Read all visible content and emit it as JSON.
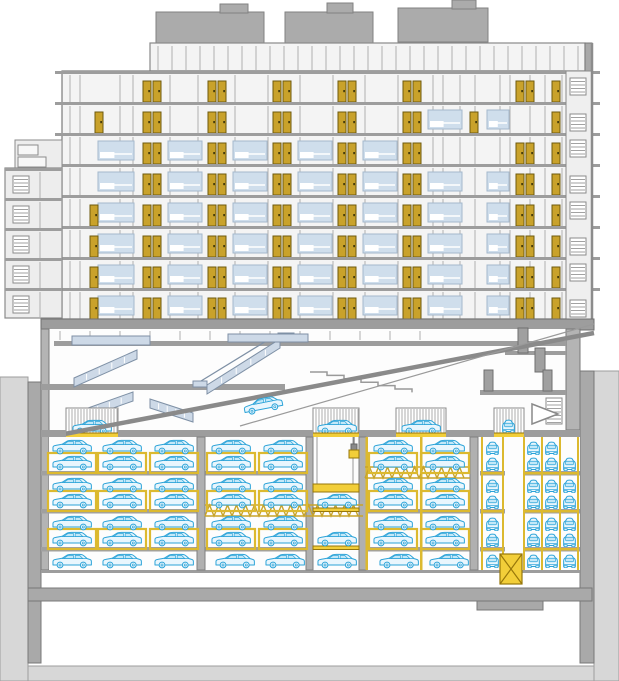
{
  "meta": {
    "title": "Architectural cross-section: residential tower over lobby and automated underground parking garage"
  },
  "palette": {
    "terrain": "#d7d7d7",
    "terrain_line": "#9e9e9e",
    "wall": "#a9a9a9",
    "wall_line": "#787878",
    "slab": "#9d9d9d",
    "floor_bg": "#f4f4f4",
    "room_bg": "#fdfdfd",
    "roof_unit": "#ababab",
    "roof_line": "#828282",
    "mullion": "#b0b0b0",
    "window_fill": "#cfdeec",
    "window_line": "#a4b8cc",
    "door_gold": "#c9a22b",
    "door_line": "#6e5a0e",
    "rack_yellow": "#dcb92f",
    "lift_yellow": "#f2ce39",
    "lift_line": "#97770a",
    "truss_yellow": "#c8a42a",
    "car_stroke": "#2ba3d8",
    "car_body": "#e9f6fd",
    "car_glass": "#c3e8f8",
    "stair_blue": "#cdd9e7",
    "stair_line": "#7e90a5"
  },
  "scene": {
    "terrain": {
      "left": [
        0,
        377,
        28,
        304
      ],
      "right": [
        594,
        371,
        25,
        310
      ],
      "bottom": [
        0,
        666,
        619,
        15
      ],
      "left_wall": [
        28,
        382,
        13,
        281
      ],
      "right_wall": [
        580,
        371,
        14,
        292
      ],
      "foundation": [
        28,
        588,
        564,
        13
      ],
      "pit": [
        477,
        588,
        66,
        22
      ]
    },
    "roof_units": [
      [
        156,
        12,
        108,
        31
      ],
      [
        220,
        4,
        28,
        9
      ],
      [
        285,
        12,
        88,
        31
      ],
      [
        327,
        3,
        26,
        10
      ],
      [
        398,
        8,
        90,
        34
      ],
      [
        452,
        0,
        24,
        9
      ]
    ],
    "top_band": {
      "x": 150,
      "y": 43,
      "w": 435,
      "h": 28,
      "mullion_step": 14
    },
    "tower": {
      "x": 62,
      "y": 71,
      "w": 523,
      "h": 248,
      "floor_h": 31,
      "slab": [
        55,
        545
      ],
      "mullions": [
        70,
        80,
        120,
        133,
        170,
        198,
        235,
        268,
        300,
        333,
        365,
        398,
        433,
        443,
        460,
        475,
        500,
        510,
        530,
        545,
        562,
        575
      ],
      "floors": [
        {
          "pairs": [
            143,
            208,
            273,
            338,
            403,
            516
          ],
          "singles": [
            552
          ],
          "windows": []
        },
        {
          "pairs": [
            143,
            208,
            273,
            338,
            403
          ],
          "singles": [
            95,
            470,
            552
          ],
          "windows": [
            [
              428,
              34
            ],
            [
              487,
              22
            ]
          ]
        },
        {
          "pairs": [
            143,
            208,
            273,
            338,
            403,
            516
          ],
          "singles": [
            552
          ],
          "windows": [
            [
              98,
              36
            ],
            [
              168,
              34
            ],
            [
              233,
              34
            ],
            [
              298,
              34
            ],
            [
              363,
              34
            ]
          ]
        },
        {
          "pairs": [
            143,
            208,
            273,
            338,
            403,
            516
          ],
          "singles": [
            552
          ],
          "windows": [
            [
              98,
              36
            ],
            [
              168,
              34
            ],
            [
              233,
              34
            ],
            [
              298,
              34
            ],
            [
              363,
              34
            ],
            [
              428,
              34
            ],
            [
              487,
              22
            ]
          ]
        },
        {
          "pairs": [
            143,
            208,
            273,
            338,
            403,
            516
          ],
          "singles": [
            90,
            552
          ],
          "windows": [
            [
              98,
              36
            ],
            [
              168,
              34
            ],
            [
              233,
              34
            ],
            [
              298,
              34
            ],
            [
              363,
              34
            ],
            [
              428,
              34
            ],
            [
              487,
              22
            ]
          ]
        },
        {
          "pairs": [
            143,
            208,
            273,
            338,
            403,
            516
          ],
          "singles": [
            90,
            552
          ],
          "windows": [
            [
              98,
              36
            ],
            [
              168,
              34
            ],
            [
              233,
              34
            ],
            [
              298,
              34
            ],
            [
              363,
              34
            ],
            [
              428,
              34
            ],
            [
              487,
              22
            ]
          ]
        },
        {
          "pairs": [
            143,
            208,
            273,
            338,
            403,
            516
          ],
          "singles": [
            90,
            552
          ],
          "windows": [
            [
              98,
              36
            ],
            [
              168,
              34
            ],
            [
              233,
              34
            ],
            [
              298,
              34
            ],
            [
              363,
              34
            ],
            [
              428,
              34
            ],
            [
              487,
              22
            ]
          ]
        },
        {
          "pairs": [
            143,
            208,
            273,
            338,
            403,
            516
          ],
          "singles": [
            90,
            552
          ],
          "windows": [
            [
              98,
              36
            ],
            [
              168,
              34
            ],
            [
              233,
              34
            ],
            [
              298,
              34
            ],
            [
              363,
              34
            ],
            [
              428,
              34
            ],
            [
              487,
              22
            ]
          ]
        }
      ]
    },
    "wing": {
      "a": [
        15,
        140,
        47,
        28
      ],
      "x": 5,
      "w": 57,
      "top": 168,
      "floor_h": 30,
      "count": 5
    },
    "shaft": {
      "x": 566,
      "y": 43,
      "w": 26,
      "bottom": 319,
      "hatch_x": 570,
      "floor_ys": [
        71,
        102,
        133,
        164,
        195,
        226,
        257,
        288
      ]
    },
    "podium": [
      41,
      319,
      553,
      11
    ],
    "lobby": {
      "bg": [
        49,
        329,
        531,
        108
      ],
      "left_wall": [
        41,
        329,
        8,
        241
      ],
      "right_wall": [
        566,
        329,
        14,
        101
      ],
      "ceiling": [
        54,
        341,
        512,
        5
      ],
      "mezz": [
        41,
        384,
        244,
        6
      ],
      "railing": {
        "x1": 60,
        "x2": 420,
        "y": 331,
        "h": 9,
        "step": 30
      },
      "landing": [
        72,
        336,
        78,
        9
      ],
      "flights": [
        [
          137,
          350,
          74,
          378
        ],
        [
          133,
          392,
          74,
          413
        ],
        [
          150,
          399,
          193,
          413
        ]
      ],
      "esc": {
        "x1": 207,
        "y1": 385,
        "x2": 280,
        "y2": 339
      },
      "esc_bar": [
        228,
        334,
        80,
        8
      ],
      "amphi": {
        "x": 310,
        "y": 372,
        "steps": 6,
        "dx": 17,
        "dy": 3.4
      },
      "ramp": [
        54,
        436,
        594,
        333
      ],
      "rail": [
        240,
        426,
        594,
        324
      ],
      "doors": [
        [
          518,
          328,
          10,
          25
        ],
        [
          535,
          348,
          10,
          24
        ],
        [
          484,
          370,
          9,
          21
        ],
        [
          543,
          370,
          9,
          21
        ]
      ],
      "slabs": [
        [
          505,
          351,
          61,
          4
        ],
        [
          480,
          390,
          86,
          5
        ]
      ],
      "stair_hatch": [
        546,
        398,
        16,
        26
      ],
      "arrow": [
        [
          532,
          404
        ],
        [
          558,
          414
        ],
        [
          532,
          424
        ]
      ],
      "lift_y": 408,
      "lift_h": 26,
      "car_y": 419,
      "lifts": [
        {
          "x": 66,
          "w": 52,
          "car": "side",
          "cx": 70
        },
        {
          "x": 313,
          "w": 46,
          "car": "side",
          "cx": 315
        },
        {
          "x": 396,
          "w": 50,
          "car": "side",
          "cx": 399
        },
        {
          "x": 494,
          "w": 30,
          "car": "front",
          "cx": 500
        }
      ],
      "ramp_car": {
        "x": 241,
        "y": 397,
        "rot": -11,
        "cx": 263,
        "cy": 405
      }
    },
    "parking": {
      "bg": [
        49,
        437,
        531,
        133
      ],
      "ceiling_y": 430,
      "ceiling_h": 7,
      "ceiling_spans": [
        [
          41,
          25
        ],
        [
          118,
          195
        ],
        [
          359,
          37
        ],
        [
          446,
          48
        ],
        [
          524,
          56
        ]
      ],
      "slabs": [
        {
          "y": 471,
          "spans": [
            [
              41,
              156
            ],
            [
              205,
              108
            ],
            [
              480,
              25
            ],
            [
              523,
              57
            ]
          ]
        },
        {
          "y": 509,
          "spans": [
            [
              41,
              156
            ],
            [
              365,
              105
            ],
            [
              480,
              25
            ],
            [
              523,
              57
            ]
          ]
        },
        {
          "y": 547,
          "spans": [
            [
              41,
              156
            ],
            [
              205,
              108
            ],
            [
              365,
              105
            ],
            [
              480,
              25
            ],
            [
              523,
              57
            ]
          ]
        }
      ],
      "floor": [
        41,
        570,
        539,
        3
      ],
      "columns": [
        [
          197,
          437,
          8,
          133
        ],
        [
          470,
          437,
          8,
          133
        ],
        [
          306,
          437,
          7,
          133
        ],
        [
          359,
          437,
          7,
          133
        ]
      ],
      "posts": [
        365.5,
        420
      ],
      "trusses": [
        [
          365,
          467,
          105,
          11
        ],
        [
          205,
          505,
          158,
          11
        ]
      ],
      "frames": {
        "ys": [
          453,
          491,
          529
        ],
        "cols": [
          50,
          100,
          152,
          209,
          261,
          371,
          423
        ]
      },
      "side_cars": [
        [
          439,
          [
            50,
            100,
            152,
            209,
            261,
            371,
            423
          ]
        ],
        [
          455,
          [
            50,
            100,
            152,
            209,
            261,
            371,
            423
          ]
        ],
        [
          477,
          [
            50,
            100,
            152,
            209,
            261,
            371,
            423
          ]
        ],
        [
          493,
          [
            50,
            100,
            152,
            209,
            261,
            315,
            371,
            423
          ]
        ],
        [
          515,
          [
            50,
            100,
            152,
            209,
            261,
            371,
            423
          ]
        ],
        [
          531,
          [
            50,
            100,
            152,
            209,
            261,
            315,
            371,
            423
          ]
        ],
        [
          553,
          [
            50,
            100,
            152,
            213,
            263,
            315,
            377,
            427
          ]
        ]
      ],
      "front_cars": [
        [
          441,
          [
            484,
            525,
            543
          ]
        ],
        [
          457,
          [
            484,
            525,
            543,
            561
          ]
        ],
        [
          479,
          [
            484,
            525,
            543,
            561
          ]
        ],
        [
          495,
          [
            484,
            525,
            543,
            561
          ]
        ],
        [
          517,
          [
            484,
            525,
            543,
            561
          ]
        ],
        [
          533,
          [
            484,
            525,
            543,
            561
          ]
        ],
        [
          554,
          [
            484,
            525,
            543,
            561
          ]
        ]
      ],
      "shelves": {
        "ys": [
          472,
          510,
          548
        ],
        "spans": [
          [
            481,
            22
          ],
          [
            523,
            56
          ]
        ]
      },
      "front_posts": [
        481,
        502,
        523,
        541,
        559,
        577
      ],
      "shaft": {
        "cables": [
          317,
          353
        ],
        "hook": {
          "line": [
            354,
            437,
            354,
            450
          ],
          "block": [
            351,
            444,
            6,
            6
          ],
          "yellow": [
            349,
            450,
            10,
            8
          ]
        },
        "platform": [
          313,
          484,
          46,
          8
        ],
        "bars": [
          [
            313,
            508,
            46,
            3.5
          ],
          [
            313,
            546,
            46,
            3.5
          ]
        ]
      },
      "xbox": [
        500,
        554,
        22,
        30
      ]
    },
    "cars": {
      "side_w": 44,
      "side_h": 15.5,
      "front_w": 17,
      "front_h": 14
    }
  }
}
